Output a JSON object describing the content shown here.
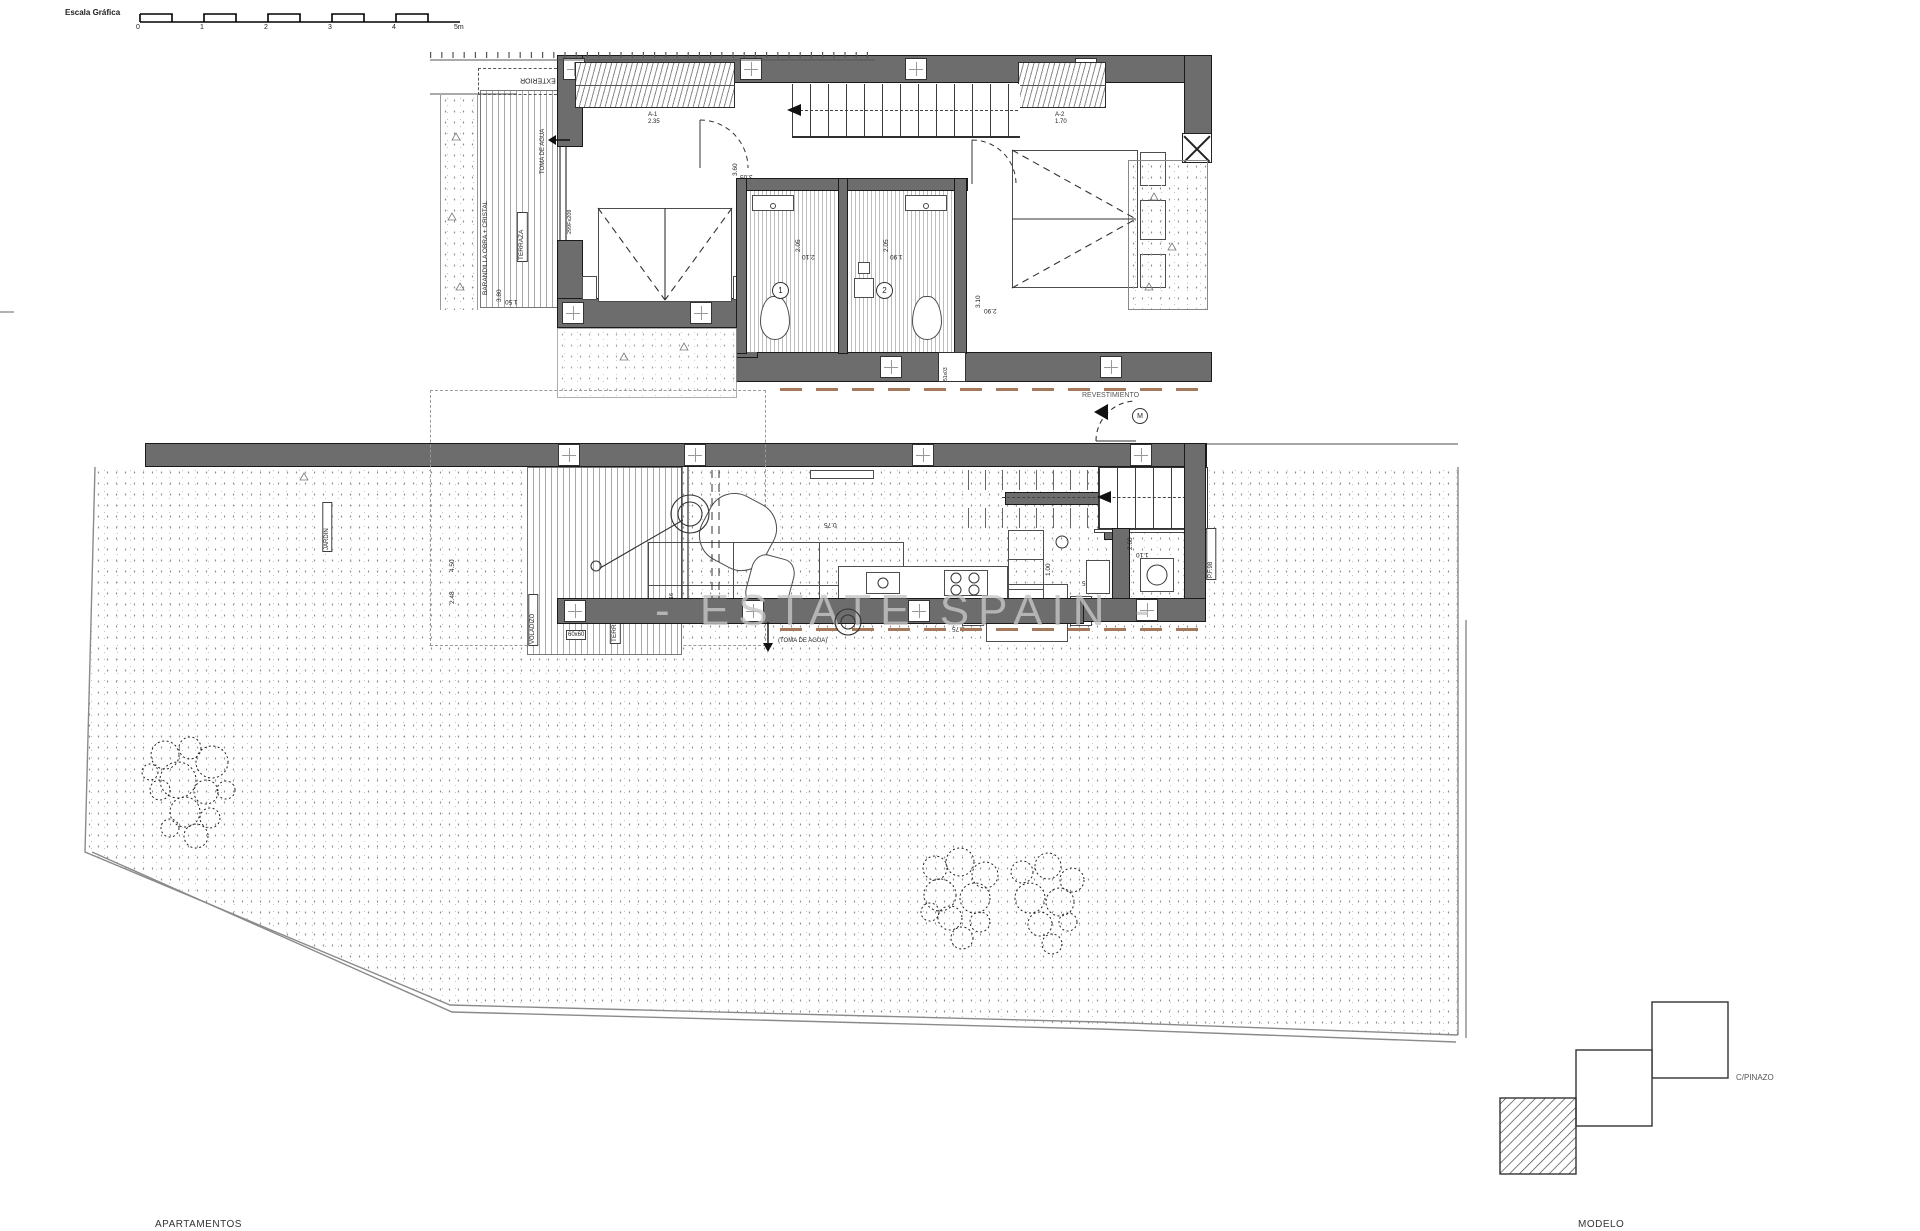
{
  "scale_bar": {
    "label": "Escala Gráfica",
    "ticks": [
      "0",
      "1",
      "2",
      "3",
      "4",
      "5m"
    ]
  },
  "watermark": "- ESTATE SPAIN -",
  "footer": {
    "left": "APARTAMENTOS",
    "right": "MODELO"
  },
  "site": {
    "street": "C/PINAZO"
  },
  "upper_floor": {
    "armario": "ARMARIO EXTERIOR",
    "toma_agua": "TOMA DE AGUA",
    "barandilla": "BARANDILLA OBRA + CRISTAL",
    "terraza": "TERRAZA",
    "glass_code": "299Fx209",
    "win1_name": "A-1",
    "win1_size": "2.35",
    "win2_name": "A-2",
    "win2_size": "1.70",
    "small_window": "51x03",
    "revestimiento": "REVESTIMIENTO",
    "dim_bed1_a": "3.60",
    "dim_bed1_b": "3.05",
    "dim_terr_a": "3.80",
    "dim_terr_b": "1.50",
    "bath1_no": "1",
    "bath1_dim_a": "2.05",
    "bath1_dim_b": "2.10",
    "bath2_no": "2",
    "bath2_dim_a": "2.05",
    "bath2_dim_b": "1.90",
    "dim_bed2_a": "3.10",
    "dim_bed2_b": "2.90"
  },
  "ground_floor": {
    "terraza": "TERRAZA",
    "voladizo": "VOLADIZO",
    "jardin": "JARDIN",
    "glass_code": "296x416",
    "tile": "60x60",
    "toma_agua": "(TOMA DE AGUA)",
    "entry_marker": "M",
    "pf_code": "P.F.98",
    "dim_garden_a": "4.50",
    "dim_garden_b": "2.48",
    "dim_living_a": "4.10",
    "dim_living_b": "8.75",
    "dim_living_c": "0.75",
    "dim_kitchen_a": "1.00",
    "dim_kitchen_b": "1.35",
    "dim_entry_a": "2.60",
    "dim_entry_b": "1.10"
  }
}
